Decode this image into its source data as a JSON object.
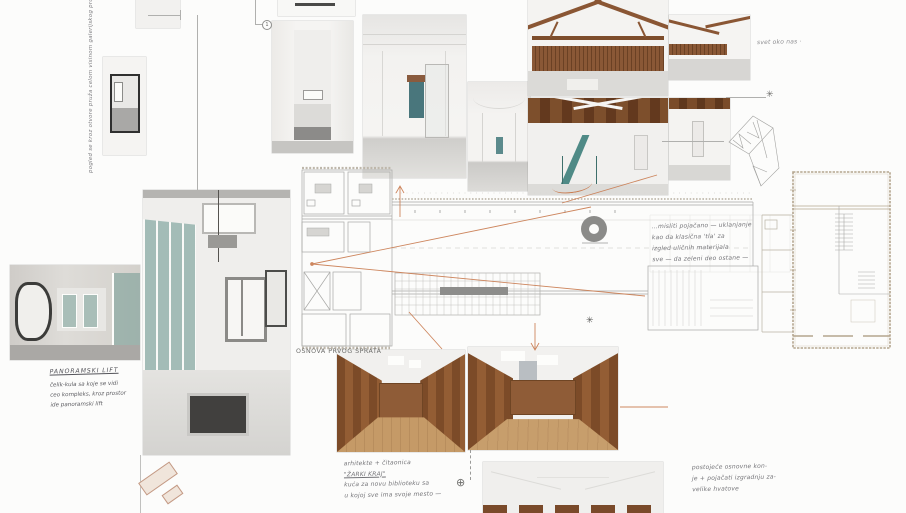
{
  "board": {
    "plan_label": "OSNOVA PRVOG SPRATA",
    "callout_marker": "1",
    "notes": {
      "vertical_left": "pogled se kroz otvore pruža celom visinom galerijskog prostora nagore",
      "top_right": "svet oko nas ·",
      "panoramic": {
        "title": "PANORAMSKI LIFT",
        "lines": [
          "čelik-kula sa koje se vidi",
          "ceo kompleks, kroz prostor",
          "ide panoramski lift"
        ]
      },
      "plan_side": {
        "lines": [
          "...misliti pojačano — uklanjanje",
          "kao da klasična 'tla' za",
          "izgled uličnih materijala",
          "sve — da zeleni deo ostane —"
        ]
      },
      "library": {
        "lines": [
          "arhitekte + čitaonica",
          "\"ŽARKI KRAJ\"",
          "kuća za novu biblioteku sa",
          "u kojoj sve ima svoje mesto —"
        ]
      },
      "structure": {
        "lines": [
          "postojeće osnovne kon-",
          "je + pojačati izgradnju za-",
          "velike hvatove"
        ]
      }
    },
    "colors": {
      "accent_orange": "#c97a4e",
      "timber_brown": "#7d4f2c",
      "teal_glass": "#4f8a86",
      "plan_line": "#a8a8a6",
      "tan_wall": "#b4a58e",
      "handwriting": "#5c5c61"
    },
    "icons": [
      "north-arrow-icon",
      "compass-icon",
      "asterisk-icon",
      "callout-marker"
    ],
    "photos": [
      {
        "id": "stair-detail-top"
      },
      {
        "id": "room-with-window"
      },
      {
        "id": "model-photo"
      },
      {
        "id": "narrow-corridor"
      },
      {
        "id": "vaulted-hall-teal-door"
      },
      {
        "id": "vaulted-corridor"
      },
      {
        "id": "attic-truss-shelves"
      },
      {
        "id": "attic-truss-corner"
      },
      {
        "id": "attic-teal-stair"
      },
      {
        "id": "white-room-beam"
      },
      {
        "id": "rounded-window-room"
      },
      {
        "id": "glass-gallery"
      },
      {
        "id": "library-shelves-1"
      },
      {
        "id": "library-shelves-2"
      },
      {
        "id": "attic-ceiling"
      },
      {
        "id": "truss-sketch"
      },
      {
        "id": "massing-sketch"
      }
    ]
  }
}
